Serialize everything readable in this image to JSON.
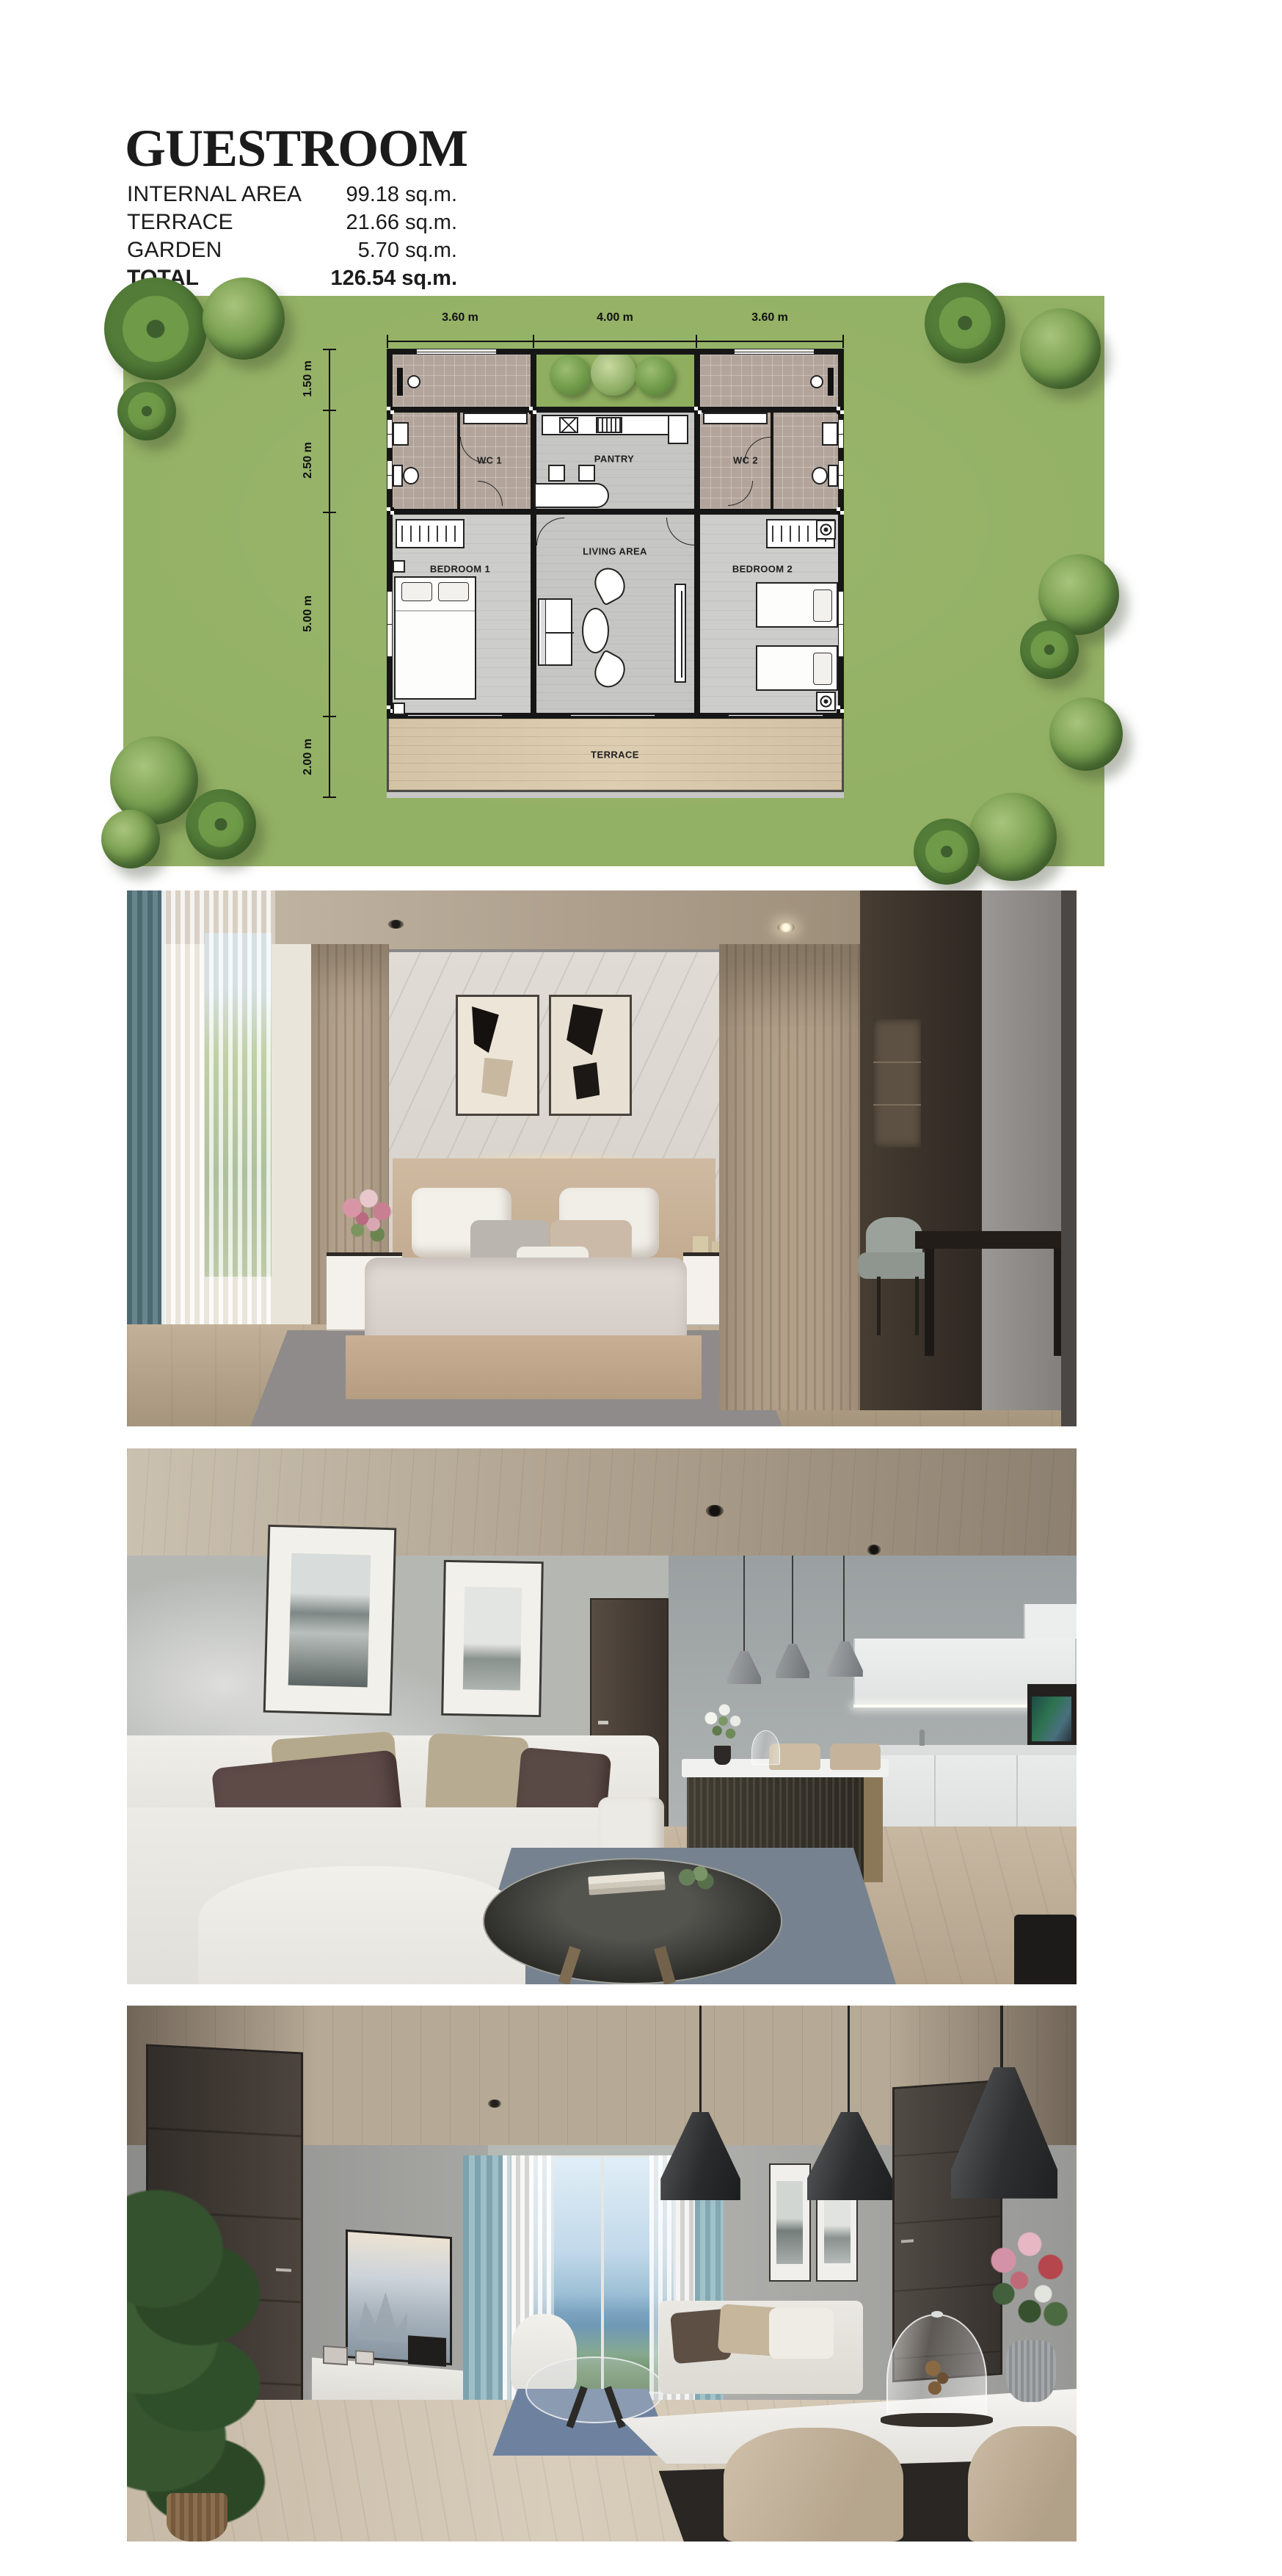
{
  "page": {
    "background": "#ffffff"
  },
  "header": {
    "title": "GUESTROOM",
    "area_table": [
      {
        "label": "INTERNAL AREA",
        "value": "99.18 sq.m."
      },
      {
        "label": "TERRACE",
        "value": "21.66 sq.m."
      },
      {
        "label": "GARDEN",
        "value": "5.70 sq.m."
      },
      {
        "label": "TOTAL",
        "value": "126.54 sq.m."
      }
    ]
  },
  "floor_plan": {
    "dimensions_top": [
      "3.60 m",
      "4.00 m",
      "3.60 m"
    ],
    "dimensions_left": [
      "1.50 m",
      "2.50 m",
      "5.00 m",
      "2.00 m"
    ],
    "rooms": {
      "wc1": "WC 1",
      "pantry": "PANTRY",
      "wc2": "WC 2",
      "bedroom1": "BEDROOM 1",
      "living_area": "LIVING AREA",
      "bedroom2": "BEDROOM 2",
      "terrace": "TERRACE"
    },
    "colors": {
      "grass": "#93b164",
      "tree": "#58813d",
      "wall": "#161616",
      "interior_floor": "#c6c7c5",
      "tile": "#b2a49a",
      "terrace_wood": "#d9c9ac"
    }
  }
}
